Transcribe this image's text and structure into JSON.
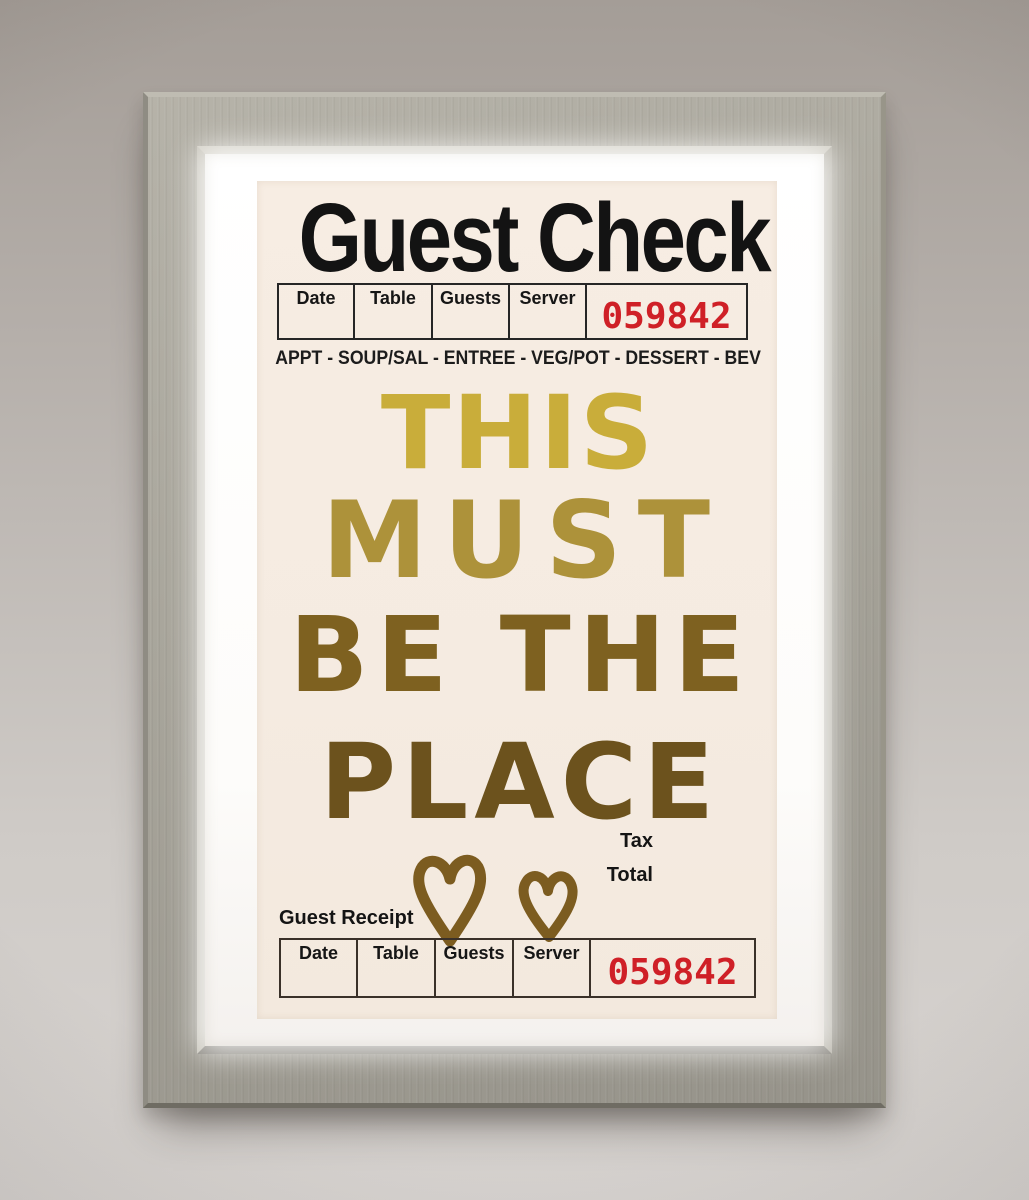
{
  "artwork": {
    "title": "Guest Check",
    "header": {
      "columns": [
        "Date",
        "Table",
        "Guests",
        "Server"
      ],
      "check_number": "059842",
      "number_color": "#cf2027"
    },
    "menu_line": "APPT - SOUP/SAL - ENTREE - VEG/POT - DESSERT - BEV",
    "message": {
      "lines": [
        {
          "text": "THIS",
          "color": "#c9ad3a"
        },
        {
          "text": "MUST",
          "color": "#ad923a"
        },
        {
          "text": "BE THE",
          "color": "#7e6120"
        },
        {
          "text": "PLACE",
          "color": "#6c521d"
        }
      ],
      "hearts_color": "#7c5c20"
    },
    "totals": {
      "tax_label": "Tax",
      "total_label": "Total"
    },
    "receipt": {
      "label": "Guest Receipt",
      "columns": [
        "Date",
        "Table",
        "Guests",
        "Server"
      ],
      "check_number": "059842",
      "number_color": "#cf2027"
    },
    "grid_color_top": "#c7a63e",
    "grid_color_bottom": "#6e5f38"
  }
}
